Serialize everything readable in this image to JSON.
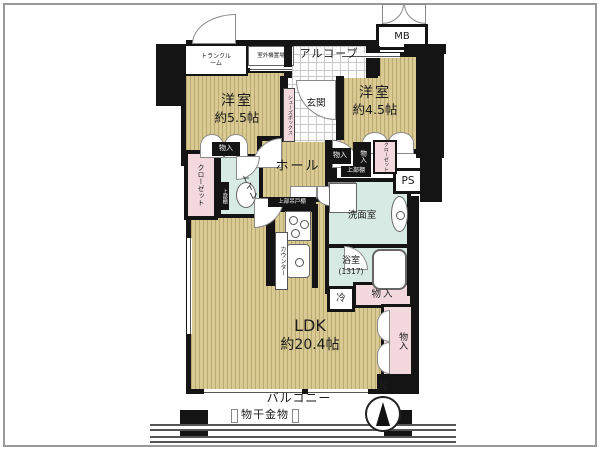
{
  "floorplan": {
    "exterior": {
      "trunk_room": "トランクルーム",
      "outdoor_unit": "室外機置場",
      "alcove": "アルコーブ",
      "mb": "MB",
      "shelf": "棚",
      "balcony": "バルコニー",
      "laundry_hardware": "物干金物",
      "compass_north": "N"
    },
    "bedroom1": {
      "name": "洋室",
      "size": "約5.5帖",
      "storage": "物入",
      "closet": "クローゼット"
    },
    "bedroom2": {
      "name": "洋室",
      "size": "約4.5帖",
      "storage_a": "物入",
      "storage_b": "物入",
      "closet": "クローゼット",
      "upper_shelf": "上部棚"
    },
    "entrance": {
      "name": "玄関",
      "shoe_box": "シューズボックス"
    },
    "hall": {
      "name": "ホール"
    },
    "toilet": {
      "name": "トイレ",
      "upper_shelf": "上部棚"
    },
    "washroom": {
      "name": "洗面室"
    },
    "bathroom": {
      "name": "浴室",
      "size": "(1317)"
    },
    "utility": {
      "ps": "PS",
      "fridge": "冷"
    },
    "ldk": {
      "name": "LDK",
      "size": "約20.4帖",
      "counter": "カウンター",
      "kitchen_shelf": "上部吊戸棚",
      "storage_h": "物入",
      "storage_v": "物入"
    },
    "colors": {
      "wall": "#141414",
      "flooring": "#d9c992",
      "wet_area": "#d8eae4",
      "closet": "#f3d8de"
    }
  }
}
